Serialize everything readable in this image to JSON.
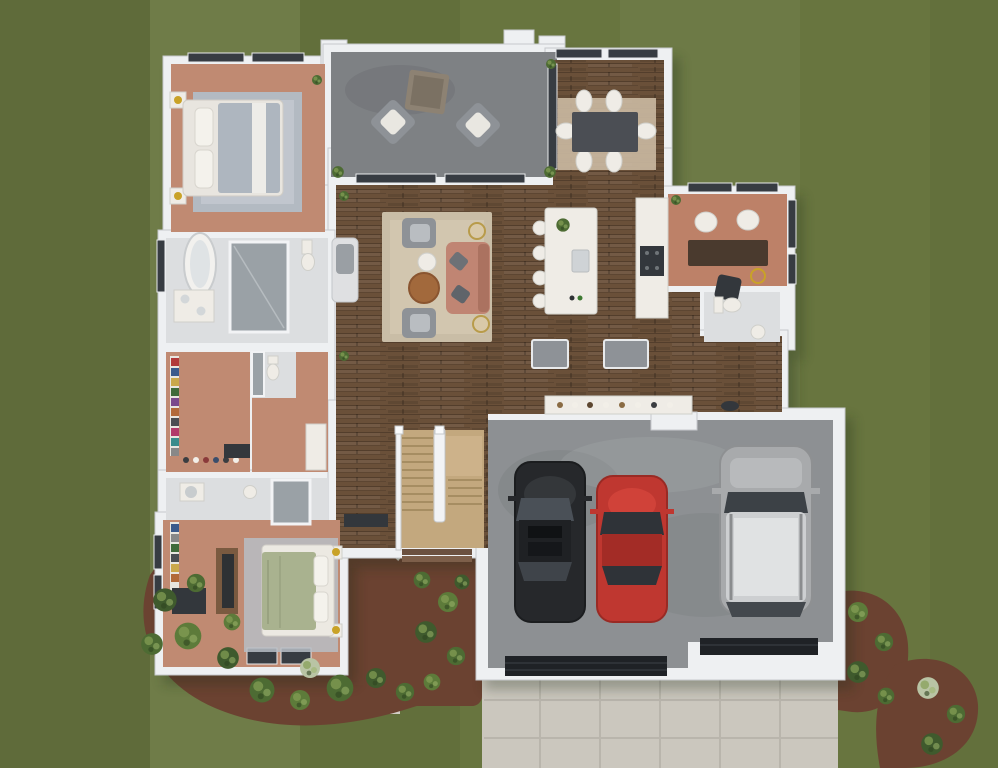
{
  "scene": {
    "description": "3D top-down architectural rendering of a single-story house floor plan on a striped green lawn with landscaping, front walkway, concrete driveway and an attached 3-car garage containing three vehicles.",
    "rooms": [
      {
        "id": "master-bedroom",
        "name": "Master Bedroom"
      },
      {
        "id": "master-bathroom",
        "name": "Master Bathroom"
      },
      {
        "id": "walk-in-closet",
        "name": "Walk-in Closet"
      },
      {
        "id": "second-bedroom",
        "name": "Second Bedroom"
      },
      {
        "id": "hall-bathroom",
        "name": "Hall Bathroom"
      },
      {
        "id": "covered-patio",
        "name": "Covered Patio"
      },
      {
        "id": "living-room",
        "name": "Living Room"
      },
      {
        "id": "dining-area",
        "name": "Dining Area"
      },
      {
        "id": "kitchen",
        "name": "Kitchen with Island"
      },
      {
        "id": "office",
        "name": "Office / Study"
      },
      {
        "id": "powder-bathroom",
        "name": "Powder Bathroom"
      },
      {
        "id": "mudroom-laundry",
        "name": "Mudroom / Laundry"
      },
      {
        "id": "staircase",
        "name": "Staircase"
      },
      {
        "id": "foyer-entry",
        "name": "Foyer / Front Entry"
      },
      {
        "id": "garage",
        "name": "3-Car Garage"
      }
    ],
    "cars": [
      {
        "slot": "left",
        "body": "sedan",
        "color": "black"
      },
      {
        "slot": "middle",
        "body": "sedan",
        "color": "red"
      },
      {
        "slot": "right",
        "body": "suv",
        "color": "silver"
      }
    ],
    "landscaping": {
      "lawn": "mowed green lawn with light stripes",
      "beds": [
        "large shrub bed at lower-left corner",
        "shrub bed beside front entry",
        "shrub bed right of garage",
        "flowering shrubs at lower-right"
      ],
      "hardscape": [
        "concrete paver walkway to front door",
        "wide concrete driveway below garage"
      ]
    }
  },
  "palette": {
    "grass_base": "#68753f",
    "wall": "#eef0f2",
    "wall_shadow": "#c6c9cc",
    "window_dark": "#373c42",
    "wood_floor": "#6a5039",
    "carpet": "#c08a72",
    "carpet_office": "#bd8168",
    "tile": "#dcdee0",
    "patio_concrete": "#7e8184",
    "garage_floor": "#8d9093",
    "driveway": "#cbc7be",
    "driveway_line": "#b5b1a8",
    "walkway": "#d2cec5",
    "mulch": "#6b4231",
    "stairs_wood": "#c3a87e",
    "white_furniture": "#efece6",
    "chair_gray": "#8e9297",
    "dark_furniture": "#33373c",
    "gold": "#c9a227",
    "sofa_salmon": "#c08573",
    "rug_beige": "#c9bda6",
    "rug_gray": "#b3bac2",
    "bed_sage": "#a9b28f",
    "table_wood": "#a2693c",
    "car_black": "#26282b",
    "car_red": "#bf3730",
    "car_silver": "#a8aaac",
    "car_glass": "#42474d",
    "bush_dark": "#3f5a2d",
    "bush_mid": "#4d6b33",
    "bush_light": "#5d7b3a",
    "bush_flower": "#b9c4a4"
  }
}
